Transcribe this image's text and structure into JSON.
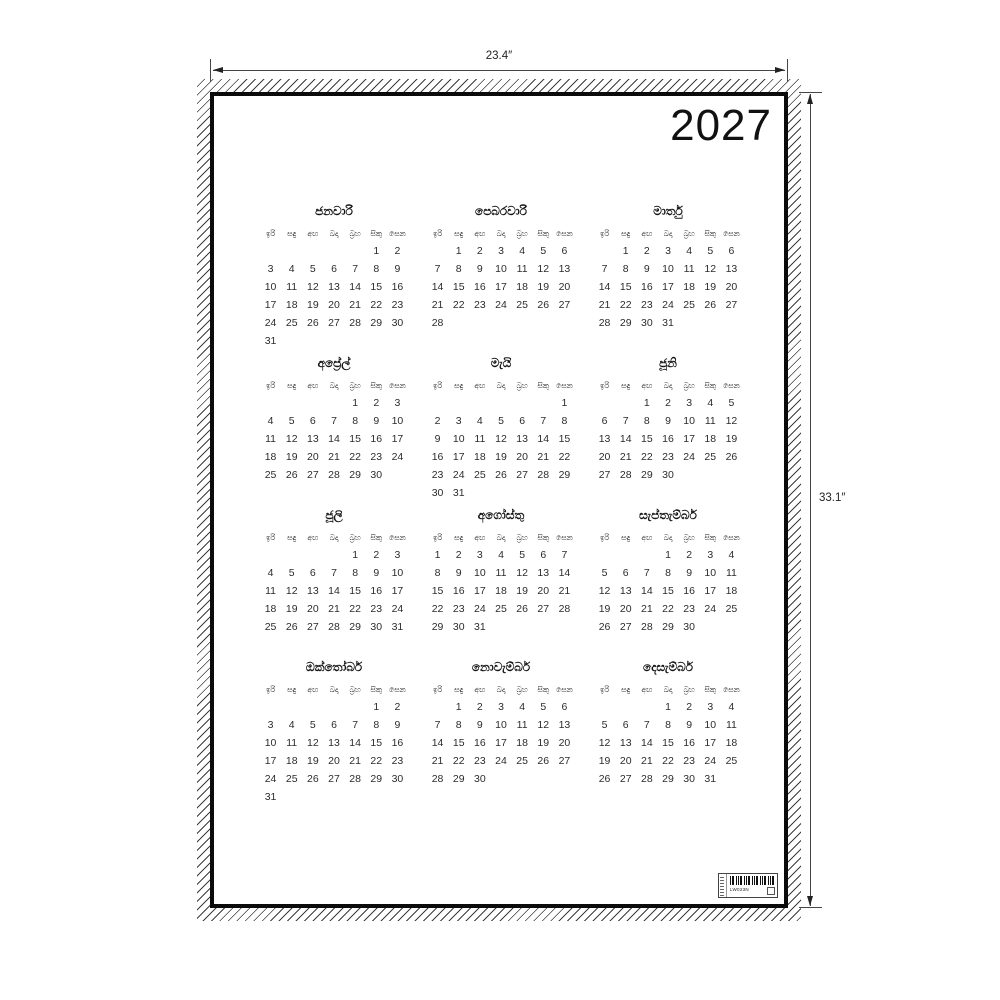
{
  "product_view": {
    "width_label": "23.4″",
    "height_label": "33.1″"
  },
  "calendar": {
    "year": "2027",
    "week_start": "sunday",
    "day_headers": [
      "ඉරි",
      "සඳු",
      "අඟ",
      "බදා",
      "බ්‍රහ",
      "සිකු",
      "සෙන"
    ],
    "months": [
      {
        "name": "ජනවාරි",
        "start_dow": 5,
        "num_days": 31
      },
      {
        "name": "පෙබරවාරි",
        "start_dow": 1,
        "num_days": 28
      },
      {
        "name": "මාර්තු",
        "start_dow": 1,
        "num_days": 31
      },
      {
        "name": "අප්‍රේල්",
        "start_dow": 4,
        "num_days": 30
      },
      {
        "name": "මැයි",
        "start_dow": 6,
        "num_days": 31
      },
      {
        "name": "ජූනි",
        "start_dow": 2,
        "num_days": 30
      },
      {
        "name": "ජූලි",
        "start_dow": 4,
        "num_days": 31
      },
      {
        "name": "අගෝස්තු",
        "start_dow": 0,
        "num_days": 31
      },
      {
        "name": "සැප්තැම්බර්",
        "start_dow": 3,
        "num_days": 30
      },
      {
        "name": "ඔක්තෝබර්",
        "start_dow": 5,
        "num_days": 31
      },
      {
        "name": "නොවැම්බර්",
        "start_dow": 1,
        "num_days": 30
      },
      {
        "name": "දෙසැම්බර්",
        "start_dow": 3,
        "num_days": 31
      }
    ]
  },
  "label": {
    "code": "LW023N",
    "icons": {
      "barcode": "barcode-icon",
      "mark": "square-mark-icon"
    }
  }
}
